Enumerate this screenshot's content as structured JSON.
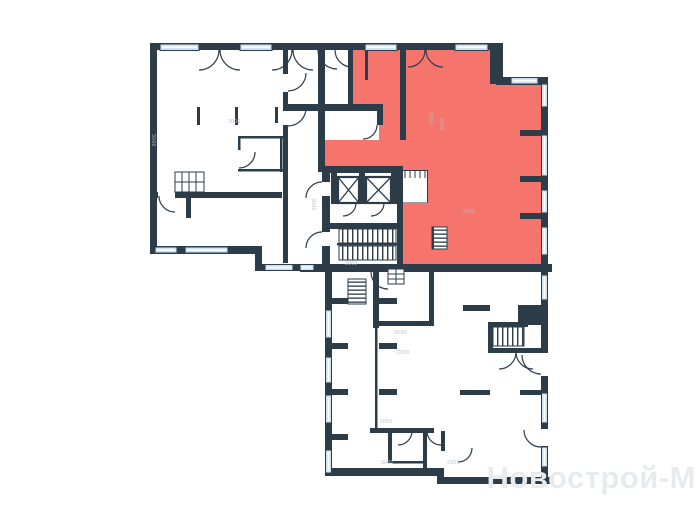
{
  "watermark": {
    "text": "Новострой-М"
  },
  "colors": {
    "wall": "#2d3c49",
    "window_fill": "#cfe3f3",
    "highlight": "#f5756d",
    "watermark": "#e8ebed",
    "dimension_text": "#b4bec7",
    "background": "#ffffff"
  },
  "plan": {
    "highlighted_unit": "red-apartment",
    "core": [
      "elevator-shaft",
      "elevator-shaft",
      "main-staircase"
    ]
  },
  "dimension_labels": [
    {
      "text": "3000",
      "x": 228,
      "y": 120,
      "rot": 0
    },
    {
      "text": "3000",
      "x": 155,
      "y": 134,
      "rot": 90
    },
    {
      "text": "3000",
      "x": 432,
      "y": 112,
      "rot": 90
    },
    {
      "text": "2000",
      "x": 443,
      "y": 118,
      "rot": 90
    },
    {
      "text": "3000",
      "x": 315,
      "y": 198,
      "rot": 90
    },
    {
      "text": "3000",
      "x": 345,
      "y": 262,
      "rot": 0
    },
    {
      "text": "3000",
      "x": 462,
      "y": 210,
      "rot": 0
    },
    {
      "text": "3000",
      "x": 394,
      "y": 331,
      "rot": 0
    },
    {
      "text": "2000",
      "x": 397,
      "y": 351,
      "rot": 0
    },
    {
      "text": "3000",
      "x": 380,
      "y": 420,
      "rot": 0
    },
    {
      "text": "3000",
      "x": 381,
      "y": 461,
      "rot": 0
    },
    {
      "text": "2000",
      "x": 447,
      "y": 461,
      "rot": 0
    }
  ]
}
